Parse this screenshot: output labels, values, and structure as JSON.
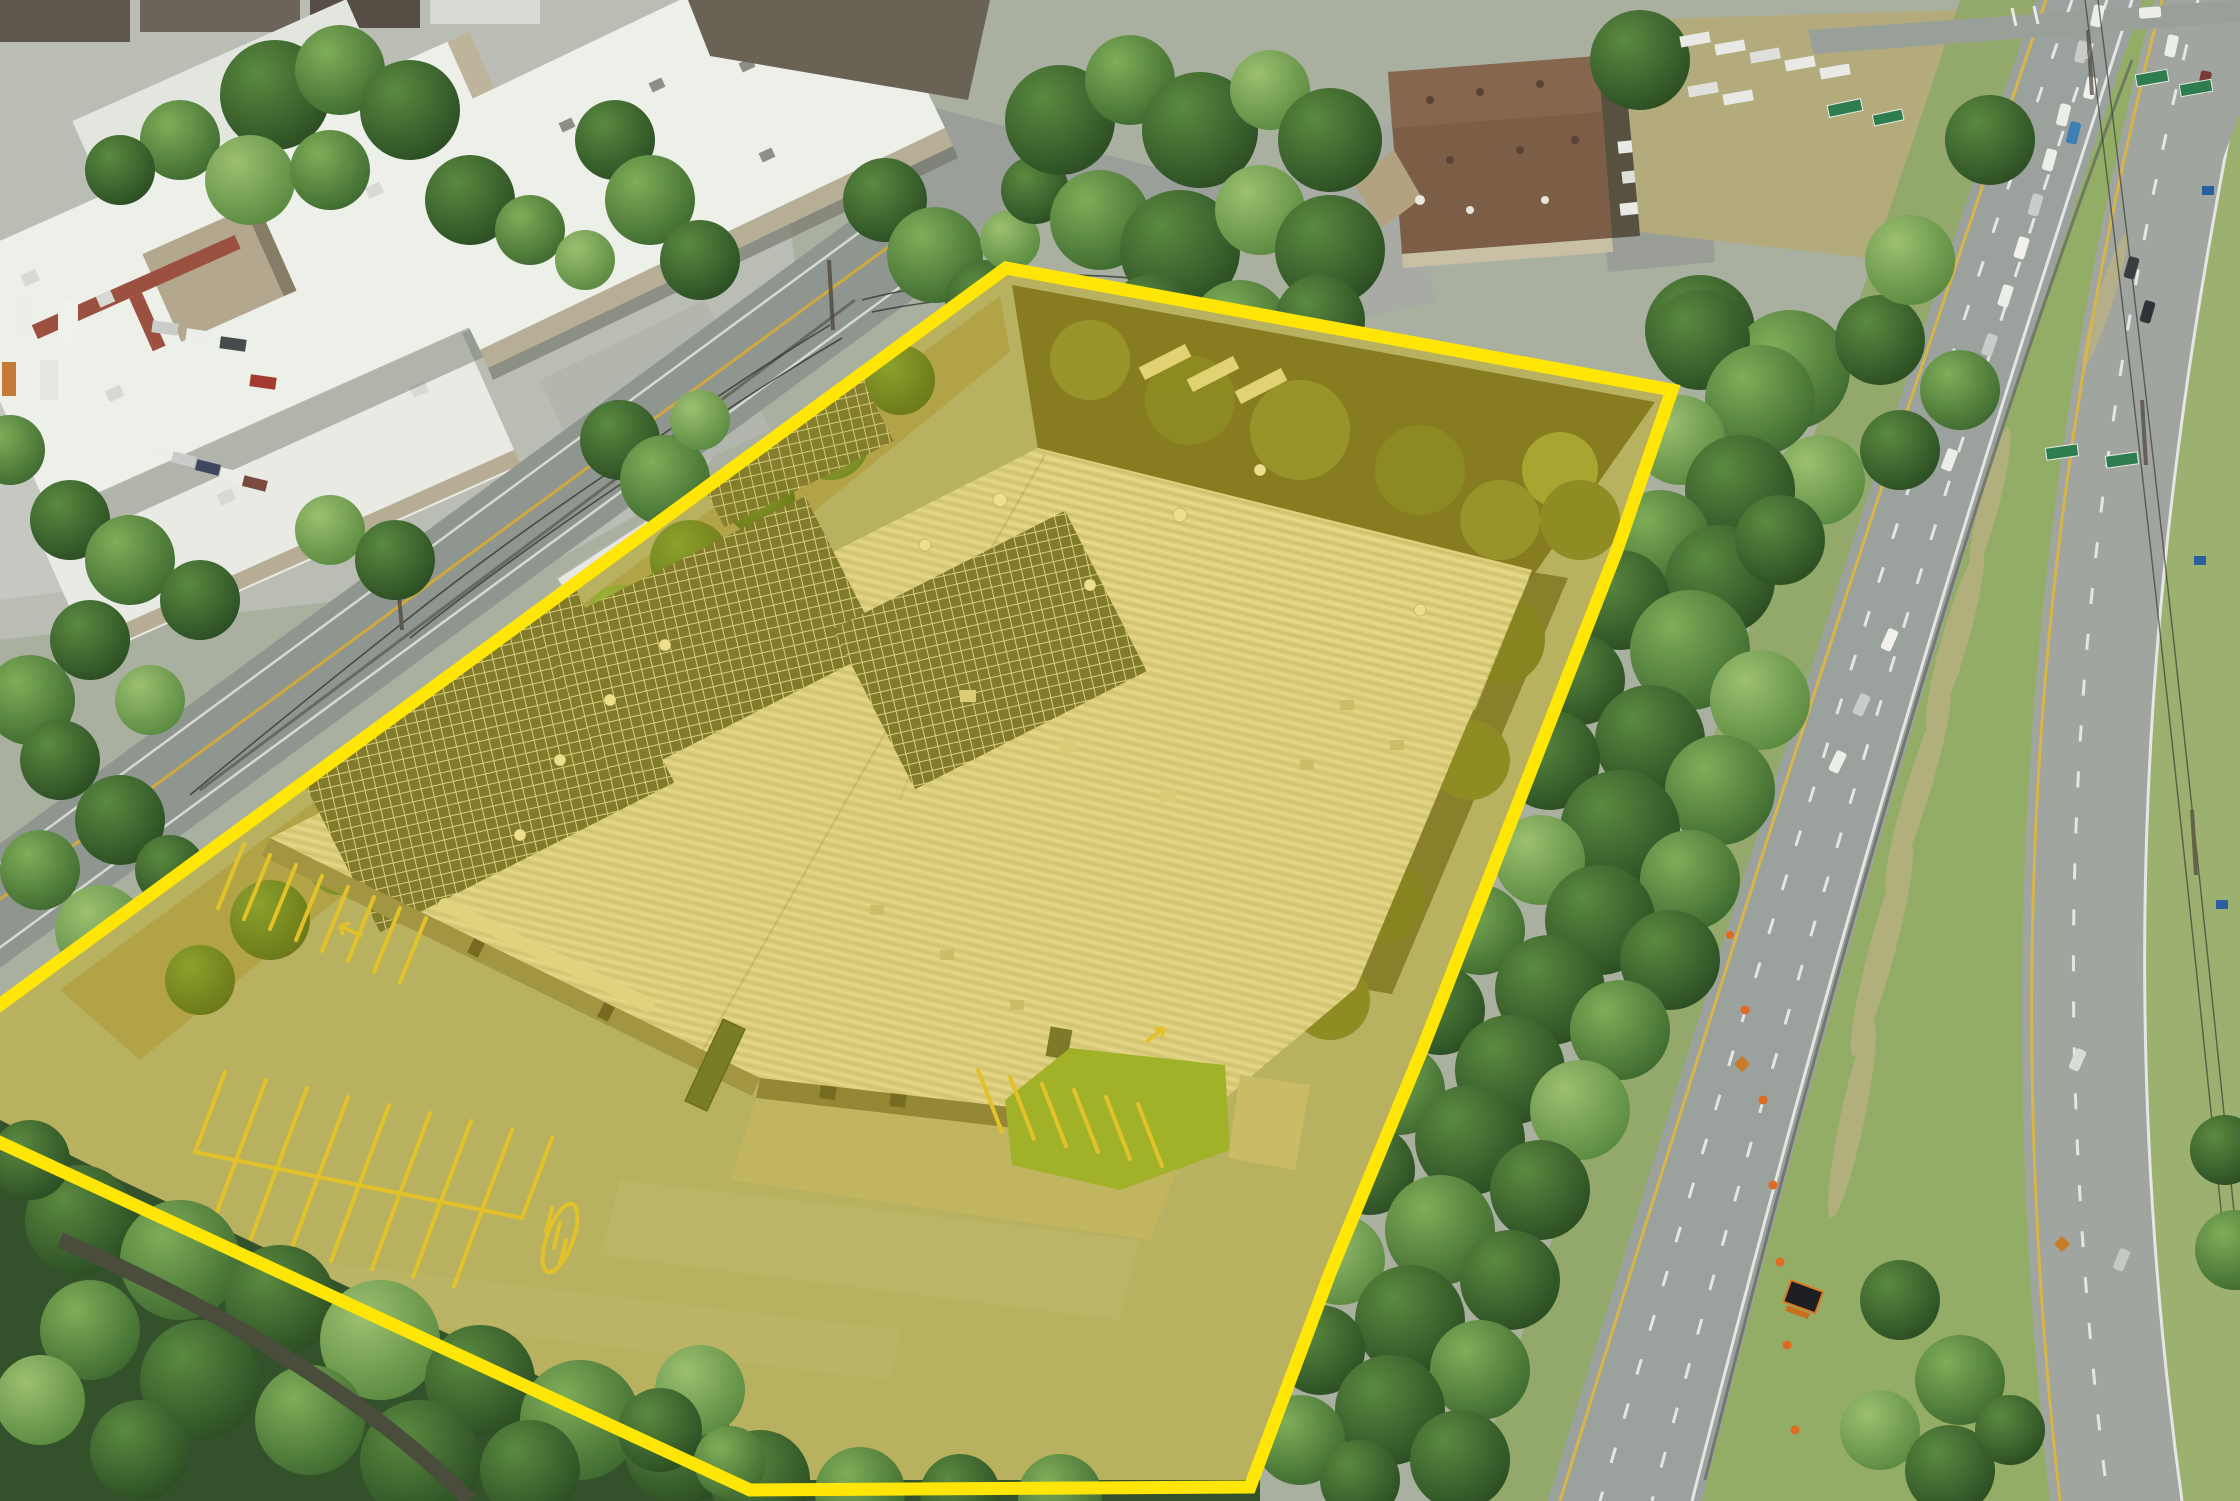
{
  "scene": {
    "type": "aerial-drone-photograph",
    "description": "Aerial view of an industrial warehouse property highlighted with a translucent yellow overlay and thick yellow boundary line; a local road and white-roofed industrial complex lie northwest, a brown-roofed industrial building and wooded buffer north-east, and a curving divided highway with traffic and a work zone runs along the east side.",
    "parcel": {
      "boundary_points": "1006,268 1672,390 1617,550 1422,1050 1330,1273 1250,1487 750,1490 -40,1124 -40,1034",
      "boundary_color": "#FFE606",
      "boundary_width": "13",
      "highlight_color": "#F5D503",
      "highlight_opacity": "0.32"
    },
    "warehouse": {
      "roof_color": "#CFCBB4",
      "solar_panel_color": "#4D5140",
      "solar_array_count": "4",
      "wall_color": "#7D7A60"
    },
    "site": {
      "pavement_color": "#9BA18D",
      "parking_stripe_color": "#D9BA3A",
      "lawn_color": "#7AA23C"
    },
    "surroundings": {
      "highway_color": "#9BA19C",
      "median_grass_color": "#93AD66",
      "tree_dark": "#2B4E23",
      "tree_mid": "#3F6A30",
      "tree_light": "#6FA04E",
      "white_roof_color": "#EDEFE9",
      "brown_roof_color": "#7C5E47",
      "green_sign_color": "#2E7D4F",
      "cone_color": "#E06A1F",
      "local_road_color": "#8F968F"
    }
  }
}
